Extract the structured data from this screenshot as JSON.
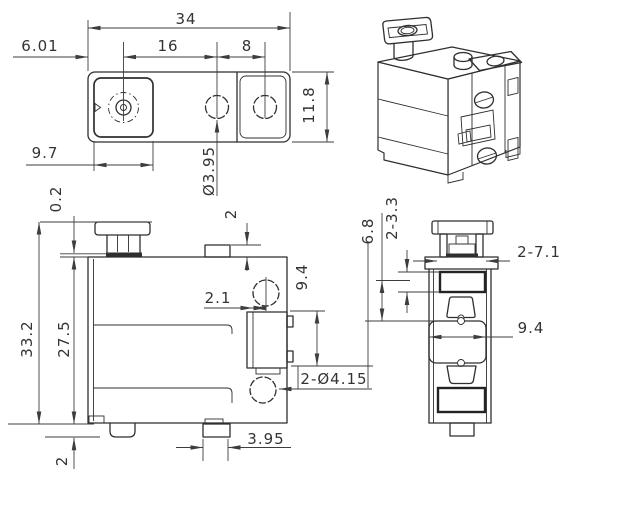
{
  "page": {
    "background": "#ffffff"
  },
  "drawing": {
    "type": "engineering-orthographic-drawing",
    "line_color": "#2f2f2f",
    "dimension_color": "#3d3d3d",
    "views": {
      "top": {
        "dims": {
          "overall_width": "34",
          "hole_pitch_left": "16",
          "hole_pitch_right": "8",
          "edge_to_hole": "6.01",
          "pocket_width": "9.7",
          "hole_diameter": "Ø3.95",
          "overall_depth": "11.8"
        }
      },
      "front": {
        "dims": {
          "knob_step": "0.2",
          "boss_height": "2",
          "overall_height": "33.2",
          "body_height": "27.5",
          "foot_height": "2",
          "wall_to_center": "2.1",
          "connector_height": "9.4",
          "hole_callout": "2-Ø4.15",
          "foot_width": "3.95"
        }
      },
      "side": {
        "dims": {
          "window_offset": "6.8",
          "window_height": "2-3.3",
          "window_width": "2-7.1",
          "pocket_width": "9.4"
        }
      }
    }
  }
}
